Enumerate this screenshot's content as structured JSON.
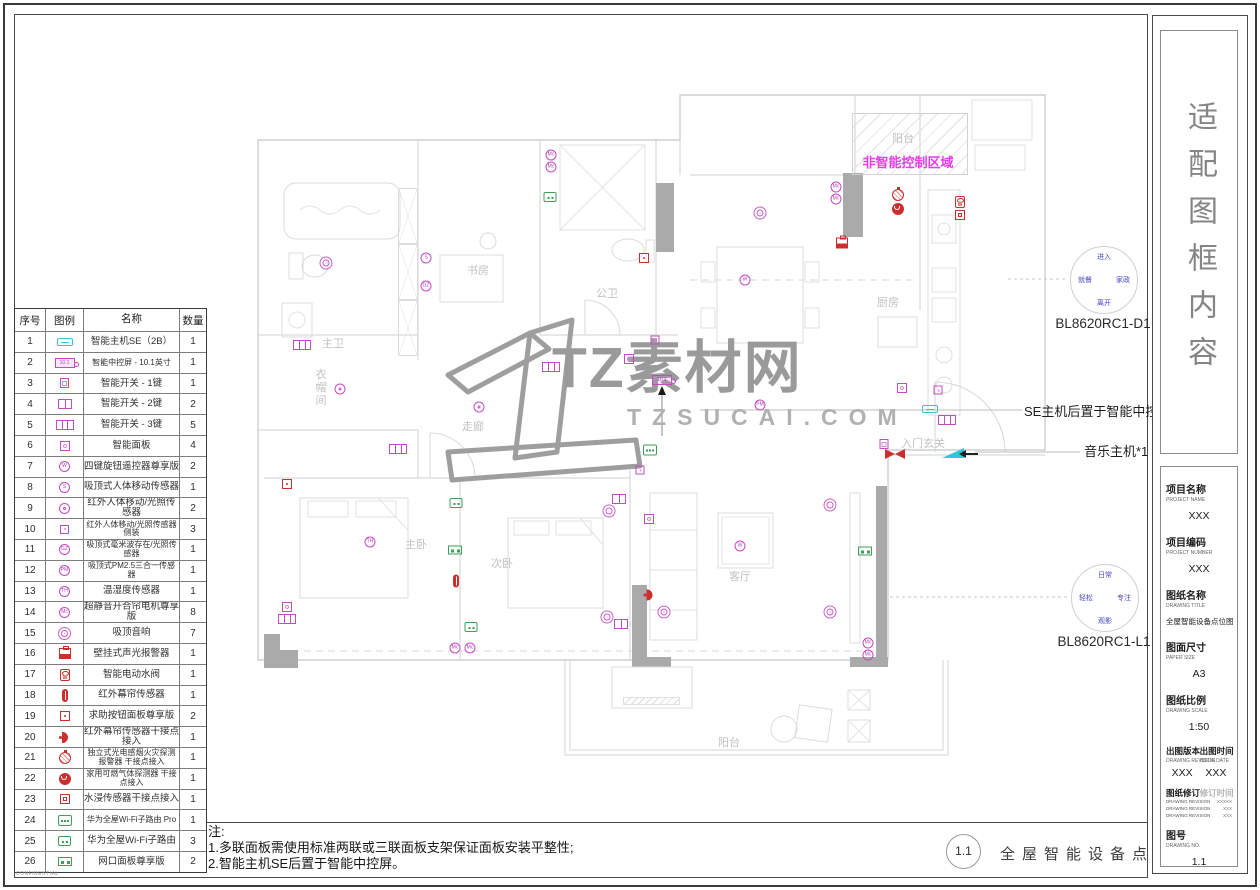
{
  "page": {
    "confidential": "CONFIDENTIAL"
  },
  "legend": {
    "headers": [
      "序号",
      "图例",
      "名称",
      "数量"
    ],
    "rows": [
      {
        "no": "1",
        "icon": "host",
        "icon_label": "",
        "name": "智能主机SE（2B）",
        "qty": "1"
      },
      {
        "no": "2",
        "icon": "scr",
        "icon_label": "10.1",
        "name": "智能中控屏 - 10.1英寸",
        "qty": "1"
      },
      {
        "no": "3",
        "icon": "sw1",
        "icon_label": "",
        "name": "智能开关 - 1键",
        "qty": "1"
      },
      {
        "no": "4",
        "icon": "sw2",
        "icon_label": "",
        "name": "智能开关 - 2键",
        "qty": "2"
      },
      {
        "no": "5",
        "icon": "sw3",
        "icon_label": "",
        "name": "智能开关 - 3键",
        "qty": "5"
      },
      {
        "no": "6",
        "icon": "panel",
        "icon_label": "",
        "name": "智能面板",
        "qty": "4"
      },
      {
        "no": "7",
        "icon": "w",
        "icon_label": "W",
        "name": "四键旋钮遥控器尊享版",
        "qty": "2"
      },
      {
        "no": "8",
        "icon": "s",
        "icon_label": "S",
        "name": "吸顶式人体移动传感器",
        "qty": "1"
      },
      {
        "no": "9",
        "icon": "irs",
        "icon_label": "",
        "name": "红外人体移动/光照传感器",
        "qty": "2"
      },
      {
        "no": "10",
        "icon": "irside",
        "icon_label": "",
        "name": "红外人体移动/光照传感器 侧装",
        "qty": "3"
      },
      {
        "no": "11",
        "icon": "gz",
        "icon_label": "GZ",
        "name": "吸顶式毫米波存在/光照传感器",
        "qty": "1"
      },
      {
        "no": "12",
        "icon": "pm",
        "icon_label": "PM",
        "name": "吸顶式PM2.5三合一传感器",
        "qty": "1"
      },
      {
        "no": "13",
        "icon": "th",
        "icon_label": "TH",
        "name": "温湿度传感器",
        "qty": "1"
      },
      {
        "no": "14",
        "icon": "mc",
        "icon_label": "Mc",
        "name": "超静音开合帘电机尊享版",
        "qty": "8"
      },
      {
        "no": "15",
        "icon": "spk",
        "icon_label": "",
        "name": "吸顶音响",
        "qty": "7"
      },
      {
        "no": "16",
        "icon": "alarm",
        "icon_label": "",
        "name": "壁挂式声光报警器",
        "qty": "1"
      },
      {
        "no": "17",
        "icon": "valve",
        "icon_label": "",
        "name": "智能电动水阀",
        "qty": "1"
      },
      {
        "no": "18",
        "icon": "curtain",
        "icon_label": "",
        "name": "红外幕帘传感器",
        "qty": "1"
      },
      {
        "no": "19",
        "icon": "help",
        "icon_label": "",
        "name": "求助按钮面板尊享版",
        "qty": "2"
      },
      {
        "no": "20",
        "icon": "curtaindry",
        "icon_label": "",
        "name": "红外幕帘传感器干接点接入",
        "qty": "1"
      },
      {
        "no": "21",
        "icon": "smoke",
        "icon_label": "",
        "name": "独立式光电感烟火灾探测报警器 干接点接入",
        "qty": "1"
      },
      {
        "no": "22",
        "icon": "gas",
        "icon_label": "",
        "name": "家用可燃气体探测器 干接点接入",
        "qty": "1"
      },
      {
        "no": "23",
        "icon": "water",
        "icon_label": "",
        "name": "水浸传感器干接点接入",
        "qty": "1"
      },
      {
        "no": "24",
        "icon": "wifipro",
        "icon_label": "",
        "name": "华为全屋Wi-Fi子路由 Pro",
        "qty": "1"
      },
      {
        "no": "25",
        "icon": "wifi",
        "icon_label": "",
        "name": "华为全屋Wi-Fi子路由",
        "qty": "3"
      },
      {
        "no": "26",
        "icon": "netport",
        "icon_label": "",
        "name": "网口面板尊享版",
        "qty": "2"
      }
    ]
  },
  "notes": {
    "title": "注:",
    "lines": [
      "1.多联面板需使用标准两联或三联面板支架保证面板安装平整性;",
      "2.智能主机SE后置于智能中控屏。"
    ]
  },
  "title_block": {
    "figure_no": "1.1",
    "title": "全屋智能设备点位图"
  },
  "sidebar": {
    "vertical_title": "适配图框内容",
    "fields": [
      {
        "zh": "项目名称",
        "en": "PROJECT NAME",
        "value": "XXX"
      },
      {
        "zh": "项目编码",
        "en": "PROJECT NUMBER",
        "value": "XXX"
      },
      {
        "zh": "图纸名称",
        "en": "DRAWING TITLE",
        "value": "全屋智能设备点位图"
      },
      {
        "zh": "图面尺寸",
        "en": "PAPER SIZE",
        "value": "A3"
      },
      {
        "zh": "图纸比例",
        "en": "DRAWING SCALE",
        "value": "1:50"
      }
    ],
    "issue": {
      "left_zh": "出图版本",
      "left_en": "DRAWING REVISION",
      "left_value": "XXX",
      "right_zh": "出图时间",
      "right_en": "ISSUE DATE",
      "right_value": "XXX"
    },
    "revision": {
      "left_zh": "图纸修订",
      "left_lines": [
        "DRAWING REVISION",
        "DRAWING REVISION",
        "DRAWING REVISION"
      ],
      "right_zh": "修订时间",
      "right_lines": [
        "XXXXX",
        "XXX",
        "XXX"
      ]
    },
    "drawing_no": {
      "zh": "图号",
      "en": "DRAWING NO.",
      "value": "1.1"
    }
  },
  "watermark": {
    "brand": "TZ素材网",
    "domain": "TZSUCAI.COM"
  },
  "plan": {
    "non_smart_label": "非智能控制区域",
    "annotations": {
      "se_note": "SE主机后置于智能中控屏",
      "music_host": "音乐主机*1"
    },
    "scene_panels": [
      {
        "model": "BL8620RC1-D1",
        "top": "进入",
        "left": "就餐",
        "right": "家政",
        "bottom": "离开"
      },
      {
        "model": "BL8620RC1-L1",
        "top": "日常",
        "left": "轻松",
        "right": "专注",
        "bottom": "观影"
      }
    ],
    "rooms": [
      {
        "label": "主卫",
        "x": 333,
        "y": 343
      },
      {
        "label": "衣帽间",
        "x": 320,
        "y": 388,
        "vertical": true
      },
      {
        "label": "书房",
        "x": 478,
        "y": 270
      },
      {
        "label": "公卫",
        "x": 607,
        "y": 293
      },
      {
        "label": "走廊",
        "x": 473,
        "y": 426
      },
      {
        "label": "厨房",
        "x": 888,
        "y": 302
      },
      {
        "label": "入门玄关",
        "x": 923,
        "y": 443
      },
      {
        "label": "客厅",
        "x": 740,
        "y": 576
      },
      {
        "label": "主卧",
        "x": 416,
        "y": 544
      },
      {
        "label": "次卧",
        "x": 502,
        "y": 563
      },
      {
        "label": "阳台",
        "x": 729,
        "y": 742
      },
      {
        "label": "阳台",
        "x": 903,
        "y": 138
      }
    ],
    "devices": [
      {
        "t": "mc",
        "l": "Mc",
        "x": 551,
        "y": 155
      },
      {
        "t": "mc",
        "l": "Mc",
        "x": 551,
        "y": 167
      },
      {
        "t": "mc",
        "l": "Mc",
        "x": 836,
        "y": 187
      },
      {
        "t": "mc",
        "l": "Mc",
        "x": 836,
        "y": 199
      },
      {
        "t": "mc",
        "l": "Mc",
        "x": 455,
        "y": 648
      },
      {
        "t": "mc",
        "l": "Mc",
        "x": 470,
        "y": 648
      },
      {
        "t": "mc",
        "l": "Mc",
        "x": 868,
        "y": 643
      },
      {
        "t": "mc",
        "l": "Mc",
        "x": 868,
        "y": 655
      },
      {
        "t": "spk",
        "x": 326,
        "y": 263
      },
      {
        "t": "spk",
        "x": 760,
        "y": 213
      },
      {
        "t": "spk",
        "x": 609,
        "y": 511
      },
      {
        "t": "spk",
        "x": 607,
        "y": 617
      },
      {
        "t": "spk",
        "x": 664,
        "y": 612
      },
      {
        "t": "spk",
        "x": 830,
        "y": 505
      },
      {
        "t": "spk",
        "x": 830,
        "y": 612
      },
      {
        "t": "w",
        "l": "W",
        "x": 745,
        "y": 280
      },
      {
        "t": "w",
        "l": "W",
        "x": 740,
        "y": 546
      },
      {
        "t": "s",
        "l": "S",
        "x": 426,
        "y": 258
      },
      {
        "t": "gz",
        "l": "GZ",
        "x": 426,
        "y": 286
      },
      {
        "t": "th",
        "l": "TH",
        "x": 370,
        "y": 542
      },
      {
        "t": "pm",
        "l": "PM",
        "x": 760,
        "y": 405
      },
      {
        "t": "scr",
        "l": "10.1",
        "x": 662,
        "y": 380
      },
      {
        "t": "irs",
        "x": 340,
        "y": 389
      },
      {
        "t": "irs",
        "x": 479,
        "y": 407
      },
      {
        "t": "irside",
        "x": 655,
        "y": 340
      },
      {
        "t": "irside",
        "x": 938,
        "y": 390
      },
      {
        "t": "irside",
        "x": 640,
        "y": 470
      },
      {
        "t": "sw3",
        "x": 302,
        "y": 345
      },
      {
        "t": "sw3",
        "x": 398,
        "y": 449
      },
      {
        "t": "sw3",
        "x": 287,
        "y": 619
      },
      {
        "t": "sw3",
        "x": 551,
        "y": 367
      },
      {
        "t": "sw3",
        "x": 947,
        "y": 420
      },
      {
        "t": "sw2",
        "x": 619,
        "y": 499
      },
      {
        "t": "sw2",
        "x": 621,
        "y": 624
      },
      {
        "t": "sw1",
        "x": 884,
        "y": 444
      },
      {
        "t": "panel",
        "x": 287,
        "y": 607
      },
      {
        "t": "panel",
        "x": 629,
        "y": 359
      },
      {
        "t": "panel",
        "x": 902,
        "y": 388
      },
      {
        "t": "panel",
        "x": 649,
        "y": 519
      },
      {
        "t": "alarm",
        "x": 842,
        "y": 243
      },
      {
        "t": "smoke",
        "x": 898,
        "y": 195
      },
      {
        "t": "gas",
        "x": 898,
        "y": 209
      },
      {
        "t": "valve",
        "x": 960,
        "y": 202
      },
      {
        "t": "water",
        "x": 960,
        "y": 215
      },
      {
        "t": "curtain",
        "x": 456,
        "y": 581
      },
      {
        "t": "curtaindry",
        "x": 649,
        "y": 595
      },
      {
        "t": "help",
        "x": 287,
        "y": 484
      },
      {
        "t": "help",
        "x": 644,
        "y": 258
      },
      {
        "t": "wifi",
        "x": 550,
        "y": 197
      },
      {
        "t": "wifi",
        "x": 456,
        "y": 503
      },
      {
        "t": "wifi",
        "x": 471,
        "y": 627
      },
      {
        "t": "wifipro",
        "x": 650,
        "y": 450
      },
      {
        "t": "netport",
        "x": 455,
        "y": 550
      },
      {
        "t": "netport",
        "x": 865,
        "y": 551
      },
      {
        "t": "host",
        "x": 930,
        "y": 409
      },
      {
        "t": "redtri",
        "x": 895,
        "y": 454
      },
      {
        "t": "cyantri",
        "x": 953,
        "y": 453
      },
      {
        "t": "blkarrow",
        "x": 972,
        "y": 454
      }
    ]
  }
}
